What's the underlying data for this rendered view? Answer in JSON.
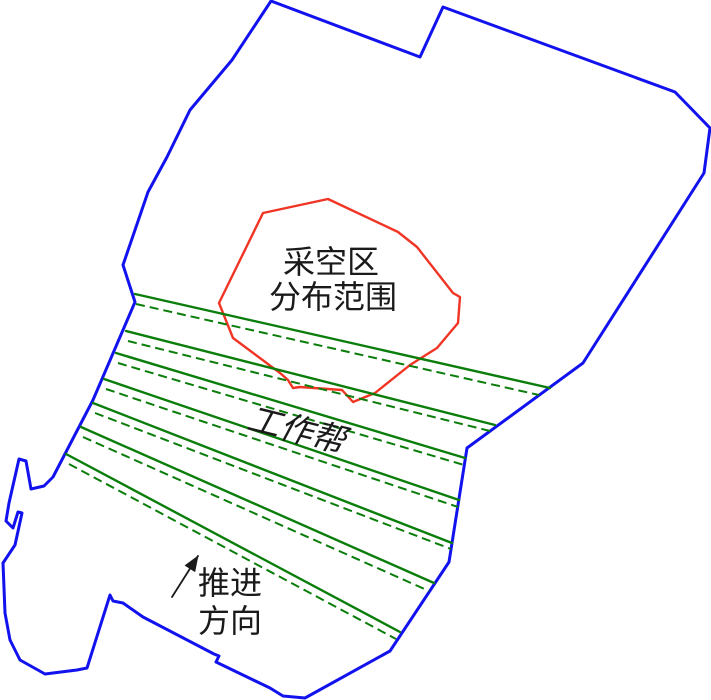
{
  "figure": {
    "width": 711,
    "height": 700,
    "background": "#ffffff",
    "description": "Open-pit mine plan diagram: blue mine boundary, red goaf distribution area, green working bench lines, advance direction arrow"
  },
  "colors": {
    "boundary": "#1212ee",
    "goaf": "#f03524",
    "bench": "#0a7d0a",
    "text": "#1a1a1a",
    "arrow": "#1a1a1a"
  },
  "labels": {
    "goaf_line1": "采空区",
    "goaf_line2": "分布范围",
    "working_slope": "工作帮",
    "advance_line1": "推进",
    "advance_line2": "方向"
  },
  "label_layout": {
    "goaf_line1": {
      "x": 331,
      "y": 262,
      "size": 32,
      "rotate": 0
    },
    "goaf_line2": {
      "x": 333,
      "y": 297,
      "size": 32,
      "rotate": 0
    },
    "working_slope": {
      "x": 296,
      "y": 431,
      "size": 33,
      "rotate": 14
    },
    "advance_line1": {
      "x": 230,
      "y": 583,
      "size": 32,
      "rotate": 0
    },
    "advance_line2": {
      "x": 230,
      "y": 621,
      "size": 32,
      "rotate": 0
    }
  },
  "boundary_points": [
    [
      271,
      1
    ],
    [
      232,
      60
    ],
    [
      190,
      110
    ],
    [
      167,
      157
    ],
    [
      148,
      192
    ],
    [
      123,
      265
    ],
    [
      135,
      302
    ],
    [
      93,
      400
    ],
    [
      53,
      477
    ],
    [
      44,
      486
    ],
    [
      31,
      489
    ],
    [
      26,
      461
    ],
    [
      19,
      459
    ],
    [
      9,
      503
    ],
    [
      6,
      521
    ],
    [
      13,
      528
    ],
    [
      18,
      512
    ],
    [
      22,
      513
    ],
    [
      15,
      545
    ],
    [
      3,
      563
    ],
    [
      5,
      613
    ],
    [
      10,
      640
    ],
    [
      20,
      660
    ],
    [
      45,
      674
    ],
    [
      77,
      670
    ],
    [
      87,
      668
    ],
    [
      110,
      595
    ],
    [
      113,
      601
    ],
    [
      123,
      603
    ],
    [
      143,
      617
    ],
    [
      214,
      654
    ],
    [
      219,
      656
    ],
    [
      216,
      662
    ],
    [
      270,
      688
    ],
    [
      283,
      696
    ],
    [
      305,
      698
    ],
    [
      390,
      651
    ],
    [
      449,
      562
    ],
    [
      467,
      448
    ],
    [
      583,
      363
    ],
    [
      704,
      173
    ],
    [
      710,
      128
    ],
    [
      675,
      92
    ],
    [
      443,
      7
    ],
    [
      420,
      57
    ]
  ],
  "goaf_points": [
    [
      328,
      199
    ],
    [
      398,
      232
    ],
    [
      417,
      247
    ],
    [
      453,
      293
    ],
    [
      460,
      297
    ],
    [
      458,
      323
    ],
    [
      437,
      348
    ],
    [
      410,
      365
    ],
    [
      375,
      393
    ],
    [
      353,
      402
    ],
    [
      342,
      390
    ],
    [
      300,
      387
    ],
    [
      293,
      388
    ],
    [
      288,
      380
    ],
    [
      280,
      373
    ],
    [
      233,
      338
    ],
    [
      225,
      318
    ],
    [
      219,
      303
    ],
    [
      263,
      213
    ]
  ],
  "benches": [
    {
      "solid": [
        135,
        294,
        550,
        388
      ],
      "dashed": [
        136,
        304,
        539,
        395
      ]
    },
    {
      "solid": [
        126,
        331,
        495,
        425
      ],
      "dashed": [
        128,
        341,
        490,
        431
      ]
    },
    {
      "solid": [
        116,
        353,
        465,
        458
      ],
      "dashed": [
        118,
        363,
        464,
        465
      ]
    },
    {
      "solid": [
        104,
        379,
        459,
        500
      ],
      "dashed": [
        106,
        389,
        458,
        507
      ]
    },
    {
      "solid": [
        93,
        403,
        452,
        543
      ],
      "dashed": [
        95,
        413,
        451,
        549
      ]
    },
    {
      "solid": [
        81,
        427,
        434,
        583
      ],
      "dashed": [
        83,
        437,
        429,
        591
      ]
    },
    {
      "solid": [
        66,
        454,
        400,
        632
      ],
      "dashed": [
        69,
        464,
        396,
        639
      ]
    }
  ],
  "arrow": {
    "x1": 172,
    "y1": 597,
    "x2": 198,
    "y2": 556
  }
}
